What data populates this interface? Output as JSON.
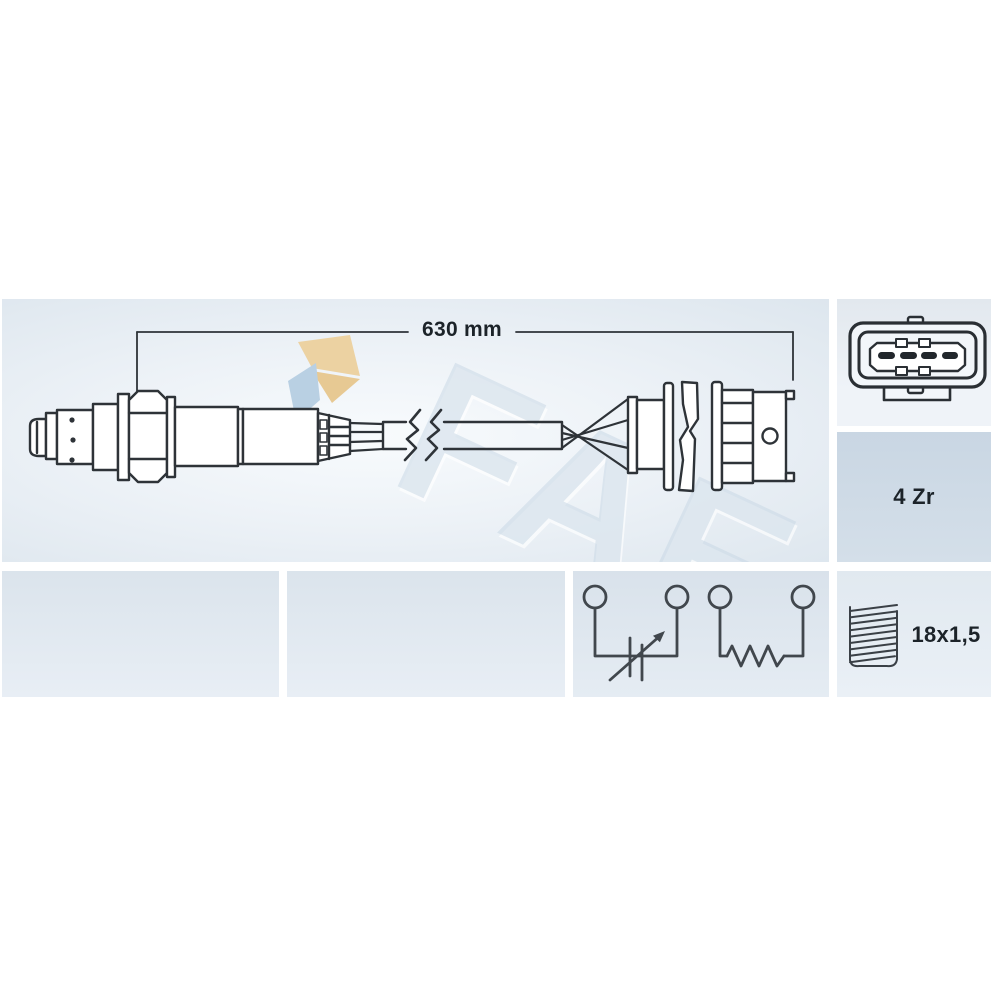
{
  "labels": {
    "cable_length": "630 mm",
    "sensor_variant": "4 Zr",
    "thread_size": "18x1,5"
  },
  "watermark": {
    "brand": "FAE"
  },
  "icons": {
    "connector_face": "4-pin-oval-connector-icon",
    "thread": "screw-thread-icon",
    "zirconia_cell": "variable-resistor-arrow-symbol",
    "heater": "resistor-zigzag-symbol",
    "cable_break": "cable-break-zigzag-symbol",
    "fae_logo": "fae-flag-logo-icon"
  },
  "colors": {
    "drawing_line": "#2e3338",
    "label_text": "#1c2329",
    "badge_panel": "#cdd9e5",
    "logo_tan": "#ecd2a2",
    "logo_blue": "#b9d0e3"
  },
  "diagram": {
    "type": "technical-drawing",
    "subject": "lambda (oxygen) sensor with cable and 4-pin connector",
    "cable_length_mm": 630,
    "connector_pins": 4,
    "circuits": [
      "sensor cell (variable resistance)",
      "heater resistor"
    ]
  }
}
